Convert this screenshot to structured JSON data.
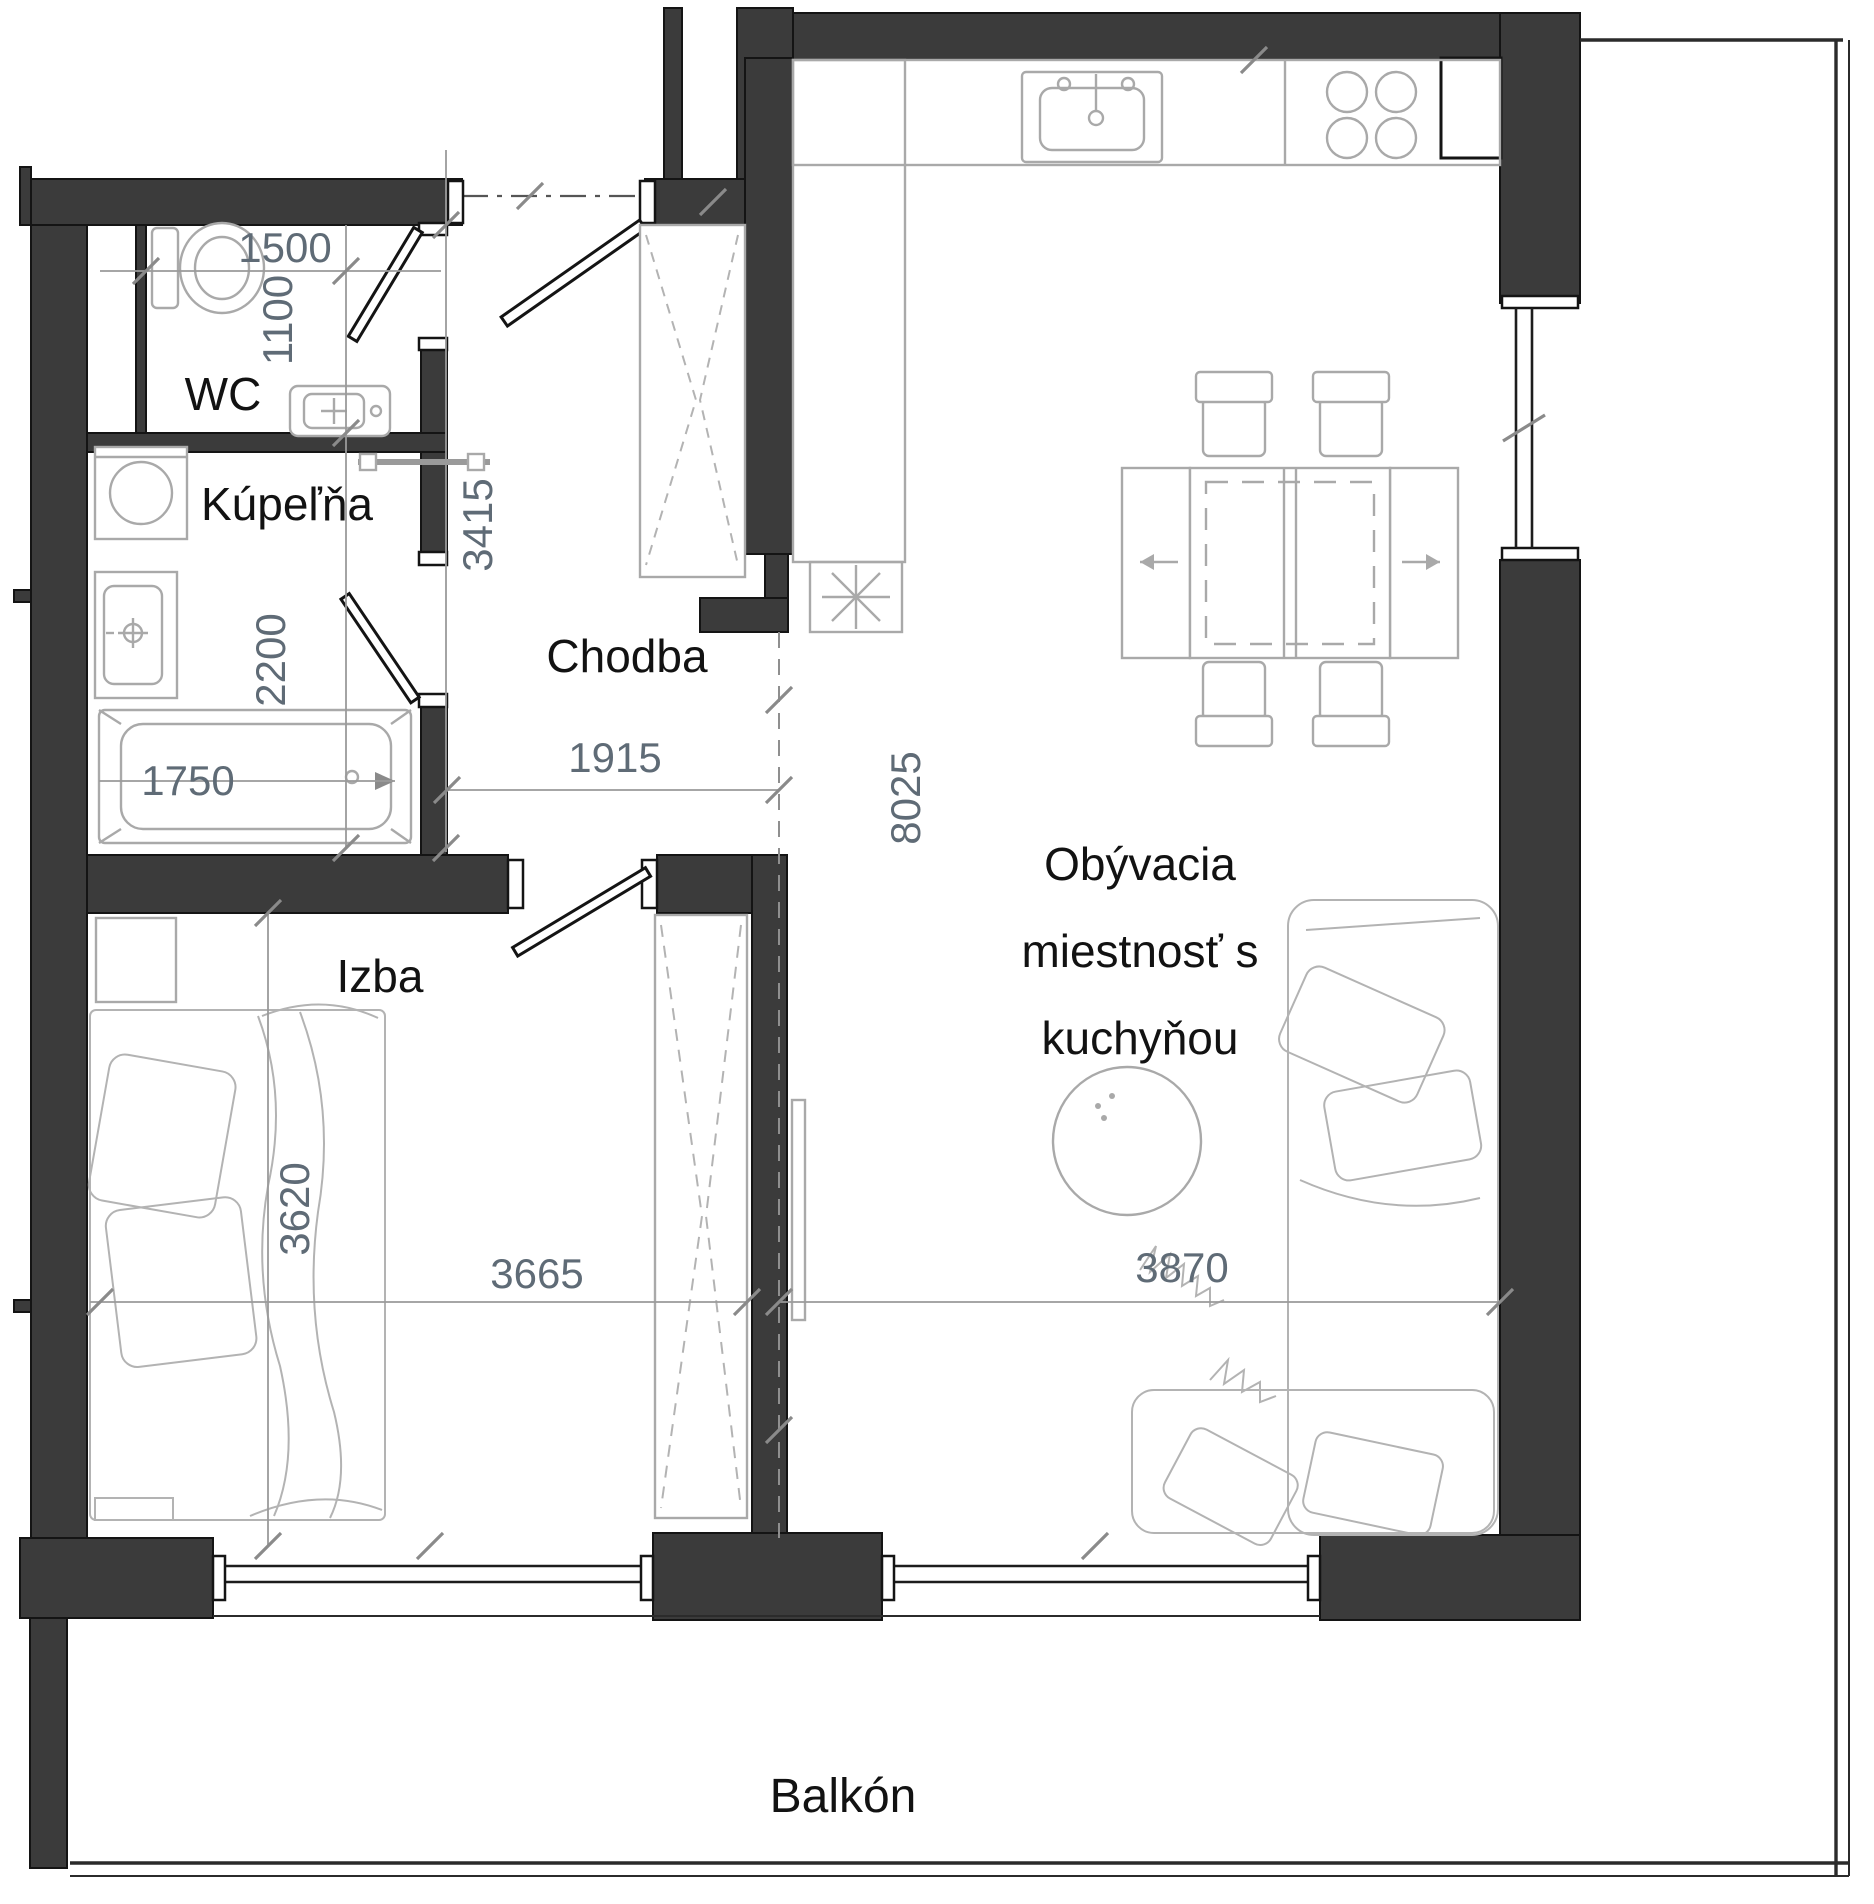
{
  "plan_type": "apartment-floor-plan",
  "labels": {
    "wc": "WC",
    "bathroom": "Kúpeľňa",
    "hallway": "Chodba",
    "bedroom": "Izba",
    "living_lines": [
      "Obývacia",
      "miestnosť s",
      "kuchyňou"
    ],
    "balcony": "Balkón"
  },
  "dimensions_mm": {
    "wc_width": "1500",
    "wc_depth": "1100",
    "hall_length": "3415",
    "bath_length": "2200",
    "bathtub_length": "1750",
    "hall_width": "1915",
    "living_length": "8025",
    "bedroom_length": "3620",
    "bedroom_width": "3665",
    "living_width": "3870"
  },
  "fixtures": [
    "toilet",
    "wc-sink",
    "towel-rail",
    "washing-machine",
    "bathroom-sink",
    "bathtub",
    "hall-closet",
    "entrance-door",
    "wc-door",
    "bathroom-door",
    "bedroom-door",
    "kitchen-counter",
    "kitchen-sink",
    "cooktop",
    "fridge-star",
    "dining-table",
    "dining-chairs",
    "round-table",
    "corner-sofa",
    "tv-board",
    "bed",
    "nightstand",
    "bedroom-wardrobe",
    "windows",
    "balcony-railing"
  ],
  "colors": {
    "bg": "#ffffff",
    "wall": "#3b3b3b",
    "wall-edge": "#141414",
    "furn": "#a9a9a9",
    "dim-line": "#9a9a9a",
    "dim-text": "#5f6b76",
    "label": "#121212"
  }
}
